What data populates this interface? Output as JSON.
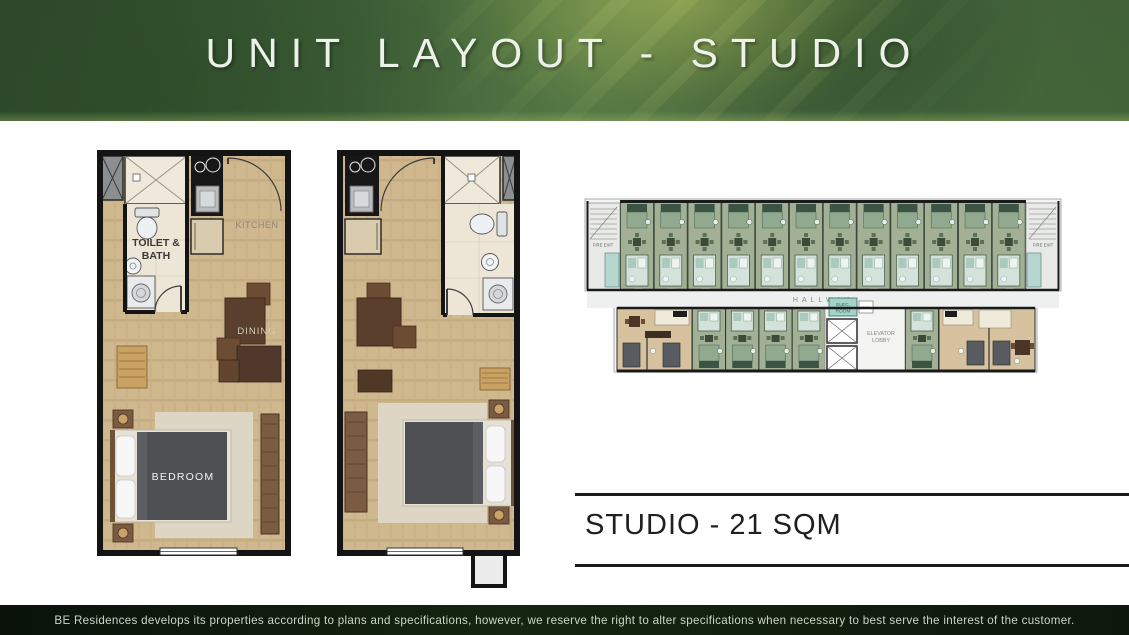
{
  "header": {
    "title": "UNIT LAYOUT - STUDIO"
  },
  "plan_left": {
    "labels": {
      "toilet_line1": "TOILET &",
      "toilet_line2": "BATH",
      "kitchen": "KITCHEN",
      "dining": "DINING",
      "bedroom": "BEDROOM"
    }
  },
  "floor_plate": {
    "labels": {
      "fire_exit_left": "FIRE EXIT",
      "fire_exit_right": "FIRE EXIT",
      "hallway": "HALLWAY",
      "elec_line1": "ELEC.",
      "elec_line2": "ROOM",
      "grc": "GRC",
      "lobby_line1": "ELEVATOR",
      "lobby_line2": "LOBBY"
    }
  },
  "unit_info": {
    "label": "STUDIO - 21 SQM"
  },
  "footer": {
    "disclaimer": "BE Residences develops its properties according to plans and specifications, however, we reserve the right to alter specifications when necessary to best serve the interest of the customer."
  },
  "colors": {
    "header_green": "#43633c",
    "header_highlight": "#c4ce60",
    "footer_bg": "#0d170c",
    "footer_text": "#ccd5c8",
    "wall": "#141414",
    "floor_wood": "#cdb58c",
    "bathroom_tile": "#ede5d6",
    "bed_blanket": "#4f5053",
    "unit_green": "#a2b096",
    "unit_green_bed": "#3a5342",
    "unit_tan": "#d6c29e",
    "teal_room": "#a7d2c8",
    "hallway_fill": "#edf0ef",
    "label_gray": "#8d8776"
  }
}
